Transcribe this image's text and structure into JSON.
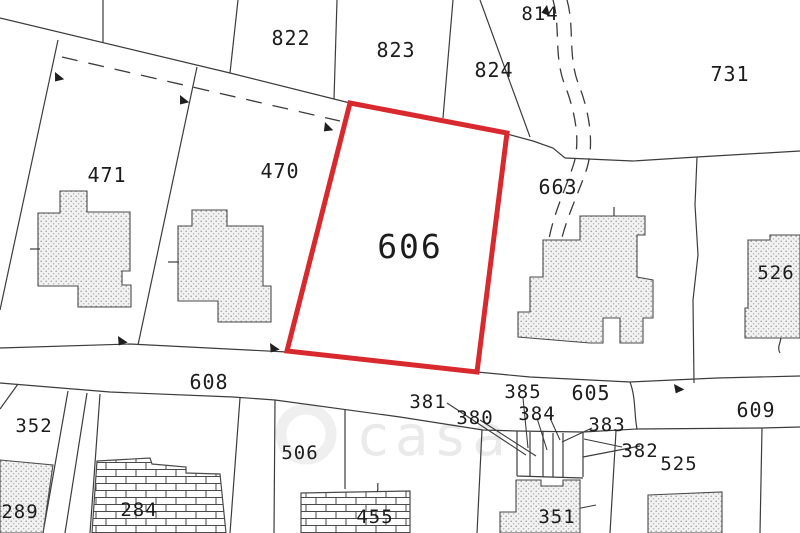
{
  "map": {
    "type": "cadastral-parcel-plan",
    "highlighted_parcel": "606",
    "outline_color": "#d8292f",
    "line_color": "#3c3c3c",
    "labels": {
      "p822": "822",
      "p823": "823",
      "p824": "824",
      "p814": "814",
      "p731": "731",
      "p471": "471",
      "p470": "470",
      "p606": "606",
      "p663": "663",
      "p526": "526",
      "p608": "608",
      "p352": "352",
      "p289": "289",
      "p284": "284",
      "p506": "506",
      "p455": "455",
      "p381": "381",
      "p380": "380",
      "p385": "385",
      "p384": "384",
      "p605": "605",
      "p383": "383",
      "p382": "382",
      "p525": "525",
      "p609": "609",
      "p351": "351"
    },
    "watermark": {
      "text": "casa"
    }
  }
}
